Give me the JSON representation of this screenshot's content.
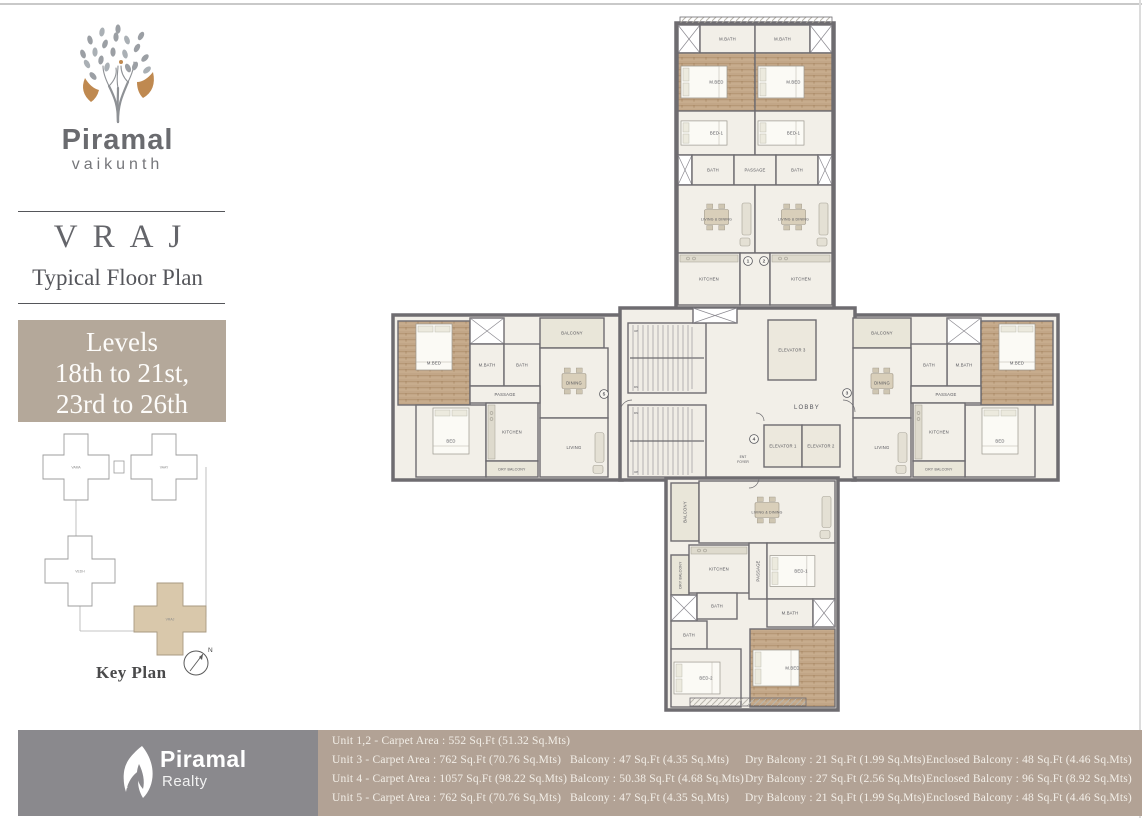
{
  "brand": {
    "name": "Piramal",
    "sub": "vaikunth"
  },
  "plan_header": {
    "tower": "VRAJ",
    "subtitle": "Typical Floor Plan"
  },
  "levels": {
    "line1": "Levels",
    "line2": "18th to 21st,",
    "line3": "23rd to 26th"
  },
  "key_plan": {
    "title": "Key Plan",
    "compass": "N",
    "buildings": [
      {
        "name": "VAMA",
        "cx": 48,
        "cy": 34,
        "aw": 24,
        "al": 66,
        "highlight": false
      },
      {
        "name": "VAAY",
        "cx": 136,
        "cy": 34,
        "aw": 24,
        "al": 66,
        "highlight": false
      },
      {
        "name": "VEDH",
        "cx": 52,
        "cy": 138,
        "aw": 24,
        "al": 70,
        "highlight": false
      },
      {
        "name": "VRAJ",
        "cx": 142,
        "cy": 186,
        "aw": 26,
        "al": 72,
        "highlight": true
      }
    ]
  },
  "floor_plan": {
    "wings": [
      {
        "name": "north-wing",
        "x": 288,
        "y": 8,
        "w": 158,
        "h": 290
      },
      {
        "name": "west-wing",
        "x": 5,
        "y": 300,
        "w": 229,
        "h": 165
      },
      {
        "name": "east-wing",
        "x": 465,
        "y": 300,
        "w": 205,
        "h": 165
      },
      {
        "name": "core",
        "x": 232,
        "y": 293,
        "w": 235,
        "h": 172
      },
      {
        "name": "south-wing",
        "x": 278,
        "y": 463,
        "w": 172,
        "h": 232
      }
    ],
    "rooms": [
      {
        "label": "",
        "type": "hatch",
        "x": 292,
        "y": 2,
        "w": 152,
        "h": 6
      },
      {
        "label": "",
        "type": "shaft",
        "x": 290,
        "y": 10,
        "w": 22,
        "h": 28
      },
      {
        "label": "M.BATH",
        "x": 312,
        "y": 10,
        "w": 55,
        "h": 28
      },
      {
        "label": "M.BATH",
        "x": 367,
        "y": 10,
        "w": 55,
        "h": 28
      },
      {
        "label": "",
        "type": "shaft",
        "x": 422,
        "y": 10,
        "w": 22,
        "h": 28
      },
      {
        "label": "M.BED",
        "type": "wood",
        "x": 290,
        "y": 38,
        "w": 77,
        "h": 58
      },
      {
        "label": "M.BED",
        "type": "wood",
        "x": 367,
        "y": 38,
        "w": 77,
        "h": 58
      },
      {
        "label": "BED-1",
        "x": 290,
        "y": 96,
        "w": 77,
        "h": 44
      },
      {
        "label": "BED-1",
        "x": 367,
        "y": 96,
        "w": 77,
        "h": 44
      },
      {
        "label": "",
        "type": "shaft",
        "x": 290,
        "y": 140,
        "w": 14,
        "h": 30
      },
      {
        "label": "BATH",
        "x": 304,
        "y": 140,
        "w": 42,
        "h": 30
      },
      {
        "label": "PASSAGE",
        "x": 346,
        "y": 140,
        "w": 42,
        "h": 30
      },
      {
        "label": "BATH",
        "x": 388,
        "y": 140,
        "w": 42,
        "h": 30
      },
      {
        "label": "",
        "type": "shaft",
        "x": 430,
        "y": 140,
        "w": 14,
        "h": 30
      },
      {
        "label": "LIVING & DINING",
        "x": 290,
        "y": 170,
        "w": 77,
        "h": 68
      },
      {
        "label": "LIVING & DINING",
        "x": 367,
        "y": 170,
        "w": 77,
        "h": 68
      },
      {
        "label": "KITCHEN",
        "x": 290,
        "y": 238,
        "w": 62,
        "h": 52
      },
      {
        "label": "",
        "x": 352,
        "y": 238,
        "w": 30,
        "h": 52
      },
      {
        "label": "KITCHEN",
        "x": 382,
        "y": 238,
        "w": 62,
        "h": 52
      },
      {
        "label": "M.BED",
        "type": "wood",
        "x": 10,
        "y": 306,
        "w": 72,
        "h": 84
      },
      {
        "label": "",
        "type": "shaft",
        "x": 82,
        "y": 303,
        "w": 34,
        "h": 26
      },
      {
        "label": "M.BATH",
        "x": 82,
        "y": 329,
        "w": 34,
        "h": 42
      },
      {
        "label": "BATH",
        "x": 116,
        "y": 329,
        "w": 36,
        "h": 42
      },
      {
        "label": "BALCONY",
        "type": "balc",
        "x": 152,
        "y": 303,
        "w": 64,
        "h": 30
      },
      {
        "label": "DINING",
        "x": 152,
        "y": 333,
        "w": 68,
        "h": 70
      },
      {
        "label": "PASSAGE",
        "x": 82,
        "y": 371,
        "w": 70,
        "h": 17
      },
      {
        "label": "BED",
        "x": 28,
        "y": 390,
        "w": 70,
        "h": 72
      },
      {
        "label": "KITCHEN",
        "x": 98,
        "y": 388,
        "w": 52,
        "h": 58
      },
      {
        "label": "DRY BALCONY",
        "type": "balc",
        "x": 98,
        "y": 446,
        "w": 52,
        "h": 16
      },
      {
        "label": "LIVING",
        "x": 152,
        "y": 403,
        "w": 68,
        "h": 59
      },
      {
        "label": "BALCONY",
        "type": "balc",
        "x": 465,
        "y": 303,
        "w": 58,
        "h": 30
      },
      {
        "label": "",
        "type": "shaft",
        "x": 559,
        "y": 303,
        "w": 34,
        "h": 26
      },
      {
        "label": "M.BATH",
        "x": 559,
        "y": 329,
        "w": 34,
        "h": 42
      },
      {
        "label": "BATH",
        "x": 523,
        "y": 329,
        "w": 36,
        "h": 42
      },
      {
        "label": "M.BED",
        "type": "wood",
        "x": 593,
        "y": 306,
        "w": 72,
        "h": 84
      },
      {
        "label": "DINING",
        "x": 465,
        "y": 333,
        "w": 58,
        "h": 70
      },
      {
        "label": "PASSAGE",
        "x": 523,
        "y": 371,
        "w": 70,
        "h": 17
      },
      {
        "label": "BED",
        "x": 577,
        "y": 390,
        "w": 70,
        "h": 72
      },
      {
        "label": "KITCHEN",
        "x": 525,
        "y": 388,
        "w": 52,
        "h": 58
      },
      {
        "label": "DRY BALCONY",
        "type": "balc",
        "x": 525,
        "y": 446,
        "w": 52,
        "h": 16
      },
      {
        "label": "LIVING",
        "x": 465,
        "y": 403,
        "w": 58,
        "h": 59
      },
      {
        "label": "",
        "type": "stair",
        "x": 240,
        "y": 308,
        "w": 78,
        "h": 70
      },
      {
        "label": "",
        "type": "stair",
        "x": 240,
        "y": 390,
        "w": 78,
        "h": 72
      },
      {
        "label": "",
        "type": "shaft",
        "x": 305,
        "y": 293,
        "w": 44,
        "h": 15
      },
      {
        "label": "ELEVATOR 3",
        "type": "lift",
        "x": 380,
        "y": 305,
        "w": 48,
        "h": 60
      },
      {
        "label": "ELEVATOR 1",
        "type": "lift",
        "x": 376,
        "y": 410,
        "w": 38,
        "h": 42
      },
      {
        "label": "ELEVATOR 2",
        "type": "lift",
        "x": 414,
        "y": 410,
        "w": 38,
        "h": 42
      },
      {
        "label": "BALCONY",
        "type": "balc",
        "vert": true,
        "x": 283,
        "y": 468,
        "w": 28,
        "h": 58
      },
      {
        "label": "LIVING & DINING",
        "x": 311,
        "y": 466,
        "w": 136,
        "h": 62
      },
      {
        "label": "DRY BALCONY",
        "type": "balc",
        "vert": true,
        "x": 283,
        "y": 540,
        "w": 18,
        "h": 40
      },
      {
        "label": "KITCHEN",
        "x": 301,
        "y": 530,
        "w": 60,
        "h": 48
      },
      {
        "label": "PASSAGE",
        "vert": true,
        "x": 361,
        "y": 528,
        "w": 18,
        "h": 56
      },
      {
        "label": "BED-1",
        "x": 379,
        "y": 528,
        "w": 68,
        "h": 56
      },
      {
        "label": "",
        "type": "shaft",
        "x": 283,
        "y": 580,
        "w": 26,
        "h": 26
      },
      {
        "label": "BATH",
        "x": 309,
        "y": 578,
        "w": 40,
        "h": 26
      },
      {
        "label": "BATH",
        "x": 283,
        "y": 606,
        "w": 36,
        "h": 28
      },
      {
        "label": "M.BATH",
        "x": 379,
        "y": 584,
        "w": 46,
        "h": 28
      },
      {
        "label": "",
        "type": "shaft",
        "x": 425,
        "y": 584,
        "w": 22,
        "h": 28
      },
      {
        "label": "BED-2",
        "x": 283,
        "y": 634,
        "w": 70,
        "h": 58
      },
      {
        "label": "M.BED",
        "type": "wood",
        "x": 362,
        "y": 614,
        "w": 85,
        "h": 78
      },
      {
        "label": "",
        "type": "hatch",
        "x": 302,
        "y": 683,
        "w": 116,
        "h": 8
      }
    ],
    "core_labels": {
      "lobby": "LOBBY",
      "ent_foyer_1": "ENT",
      "ent_foyer_2": "FOYER",
      "up": "UP",
      "dn": "DN"
    },
    "markers": [
      {
        "n": "1",
        "x": 360,
        "y": 246
      },
      {
        "n": "2",
        "x": 376,
        "y": 246
      },
      {
        "n": "3",
        "x": 459,
        "y": 378
      },
      {
        "n": "4",
        "x": 366,
        "y": 424
      },
      {
        "n": "5",
        "x": 216,
        "y": 379
      }
    ]
  },
  "footer": {
    "realty": {
      "name": "Piramal",
      "sub": "Realty"
    },
    "rows": [
      [
        "Unit 1,2 - Carpet Area : 552 Sq.Ft  (51.32 Sq.Mts)",
        "",
        "",
        ""
      ],
      [
        "Unit 3 - Carpet Area : 762 Sq.Ft  (70.76 Sq.Mts)",
        "Balcony : 47  Sq.Ft  (4.35 Sq.Mts)",
        "Dry Balcony : 21 Sq.Ft  (1.99 Sq.Mts)",
        "Enclosed Balcony : 48 Sq.Ft  (4.46 Sq.Mts)"
      ],
      [
        "Unit 4 - Carpet Area : 1057 Sq.Ft  (98.22 Sq.Mts)",
        "Balcony : 50.38  Sq.Ft  (4.68 Sq.Mts)",
        "Dry Balcony : 27 Sq.Ft  (2.56 Sq.Mts)",
        "Enclosed Balcony : 96 Sq.Ft  (8.92 Sq.Mts)"
      ],
      [
        "Unit 5 - Carpet Area : 762 Sq.Ft  (70.76 Sq.Mts)",
        "Balcony : 47  Sq.Ft  (4.35 Sq.Mts)",
        "Dry Balcony : 21 Sq.Ft  (1.99 Sq.Mts)",
        "Enclosed Balcony : 48 Sq.Ft  (4.46 Sq.Mts)"
      ]
    ]
  },
  "colors": {
    "wall": "#6e6c70",
    "floor": "#f2efe8",
    "wood": "#c2a687",
    "wood_dark": "#9f7e58",
    "balcony": "#e9e6d9",
    "lift": "#ece8dd",
    "stair": "#f0ede6",
    "label": "#54545a",
    "accent_tan": "#b2a295",
    "footer_gray": "#8a898d",
    "levels_bg": "#b4a89a",
    "keyplan_fill": "#d9c8ab",
    "logo_gray": "#9b9fa4",
    "logo_tan": "#bf8950"
  }
}
